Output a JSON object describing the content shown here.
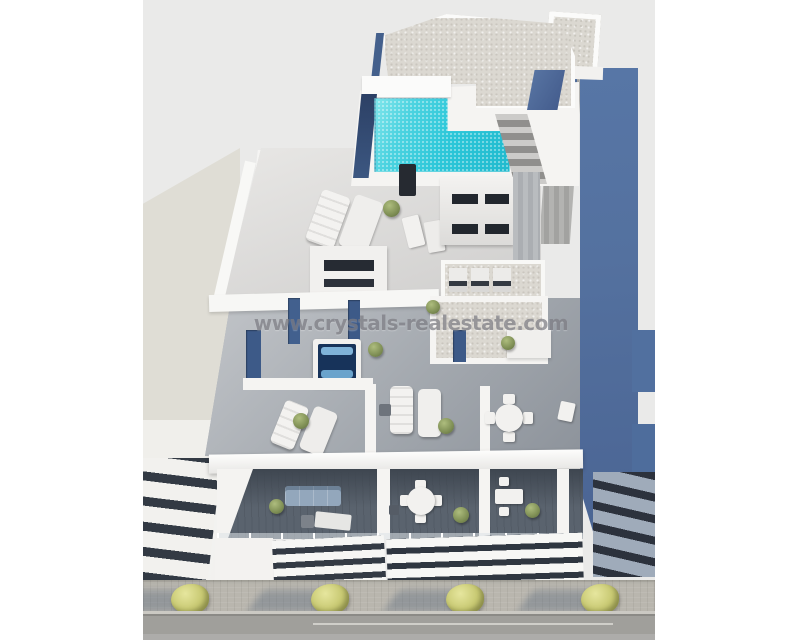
{
  "watermark": {
    "text": "www.crystals-realestate.com"
  },
  "scene": {
    "subject": "aerial 3d render of a modern white apartment building",
    "elements": [
      "rooftop-pool",
      "gravel-roof",
      "staircase",
      "roof-terrace",
      "sun-loungers",
      "stair-bulkhead",
      "ac-units",
      "jacuzzi",
      "mid-terraces",
      "dining-set",
      "balconies",
      "sofa",
      "louvered-facade",
      "sidewalk",
      "street-trees",
      "road",
      "neighbor-buildings"
    ]
  },
  "palette": {
    "page_bg": "#ffffff",
    "sky": "#eaeae9",
    "beige_wall": "#dfddd5",
    "white_wall": "#f5f4f2",
    "bright_white": "#fbfbfa",
    "gravel": "#dbd8d1",
    "gravel_dot": "#c9c6be",
    "pool_water": "#2cc7d9",
    "pool_light": "#85e7ec",
    "navy_accent": "#3d5a88",
    "navy_deep": "#2c4065",
    "steel_blue": "#5776a6",
    "deck_light": "#dedddb",
    "deck_mid": "#a6abb1",
    "deck_dark": "#5a636e",
    "balcony_shadow": "#3e4650",
    "louver_dark": "#333a44",
    "sofa_blue": "#93a7bc",
    "plant_green": "#7f8f55",
    "tree_yellow": "#c9ca74",
    "tree_highlight": "#e6e69e",
    "sidewalk": "#b9b6ae",
    "road": "#a09f9b",
    "lane_line": "#d7d6d1",
    "watermark_color": "#7d7d84"
  }
}
